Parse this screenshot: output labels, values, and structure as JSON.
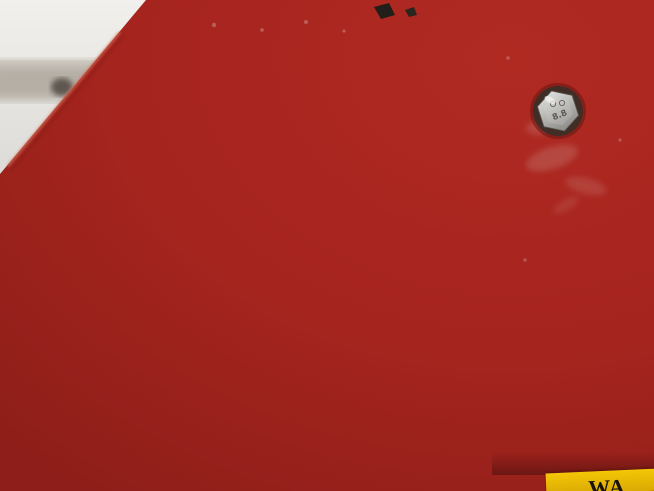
{
  "colors": {
    "plate_red": "#a5241e",
    "backdrop_white": "#eeede9",
    "label_grey": "#d8d7d3",
    "ink": "#55544f",
    "warning_yellow": "#ecbd06"
  },
  "scene": {
    "bolt": {
      "marking": "8.8"
    },
    "yellow_label": {
      "partial_text": "WA"
    }
  },
  "label": {
    "info_table": {
      "load_names": [
        "Carico nominale",
        "Rated load",
        "Nenntragfähigkeit in kg",
        "Charge nominale",
        "Carga clasificada"
      ],
      "max_prefix": "max:(",
      "plus": "+",
      "max_suffix": ")=200 Kg",
      "person_prefix": "(",
      "person_suffix": ")=80 Kg",
      "manual_lines": [
        "Vedi Manuale",
        "See Manual",
        "Handbuch sehen",
        "Voir le manuel",
        "Ver el manual"
      ],
      "warning_symbol": "!"
    },
    "side_note_line1": "DATI INDICATIVI - APPROXIMATE DATA - TECHNISCHE AENDERUNGEN VORBEHALTEN",
    "side_note_line2": "DONNEES INDICATIVES - DATOS APROXIMADOS",
    "outrigger_modes": [
      "stabilizers-retracted",
      "working-area-left-side",
      "working-area-right-side",
      "full-working-area-360"
    ],
    "title_block": {
      "field_label": "DENOMINAZIONE",
      "title": "GRAFICO DI LAVORO",
      "drawing_number": "439.419"
    }
  },
  "chart_data": {
    "type": "line",
    "title": "Working envelope diagram (GRAFICO DI LAVORO)",
    "model": "E200TE4",
    "x_axis": {
      "range": [
        -3,
        15
      ],
      "ticks": [
        0,
        3,
        6,
        9,
        12
      ],
      "end_label": "15 m",
      "units": "m"
    },
    "y_axis": {
      "range": [
        0,
        21
      ],
      "ticks": [
        3,
        6,
        9,
        12,
        15,
        18
      ],
      "top_label": "21 m",
      "units": "m",
      "position": "right"
    },
    "grid_step_m": 3,
    "series": [
      {
        "name": "outer envelope - 1 person (80 Kg)",
        "style": "solid",
        "points": [
          [
            -0.5,
            3.3
          ],
          [
            -1.7,
            4.8
          ],
          [
            -1.1,
            7.0
          ],
          [
            -2.2,
            8.8
          ],
          [
            -2.7,
            11.2
          ],
          [
            -2.8,
            13.6
          ],
          [
            -2.2,
            16.2
          ],
          [
            -1.0,
            18.4
          ],
          [
            0.3,
            19.6
          ],
          [
            1.8,
            20.2
          ],
          [
            3.6,
            20.3
          ],
          [
            5.3,
            19.9
          ],
          [
            7.4,
            18.5
          ],
          [
            9.6,
            16.4
          ],
          [
            11.3,
            14.0
          ],
          [
            12.3,
            11.2
          ],
          [
            12.6,
            8.5
          ],
          [
            12.3,
            5.6
          ],
          [
            11.6,
            2.8
          ],
          [
            10.6,
            1.0
          ],
          [
            8.8,
            0.6
          ],
          [
            6.4,
            0.6
          ],
          [
            4.4,
            0.8
          ],
          [
            3.3,
            1.0
          ]
        ]
      },
      {
        "name": "inner envelope - 2 persons + tools (200 Kg)",
        "style": "dashed",
        "points": [
          [
            5.1,
            17.7
          ],
          [
            6.4,
            16.0
          ],
          [
            7.7,
            13.7
          ],
          [
            8.7,
            11.2
          ],
          [
            9.2,
            8.6
          ],
          [
            9.3,
            6.2
          ],
          [
            9.0,
            3.7
          ],
          [
            8.3,
            1.7
          ],
          [
            7.0,
            0.95
          ],
          [
            5.3,
            0.9
          ],
          [
            3.9,
            1.0
          ]
        ]
      }
    ],
    "annotations": [
      {
        "icon": "two-persons-plus-tools",
        "x": 5.0,
        "y": 6.2
      },
      {
        "icon": "one-person",
        "x": 9.4,
        "y": 6.2
      }
    ]
  }
}
